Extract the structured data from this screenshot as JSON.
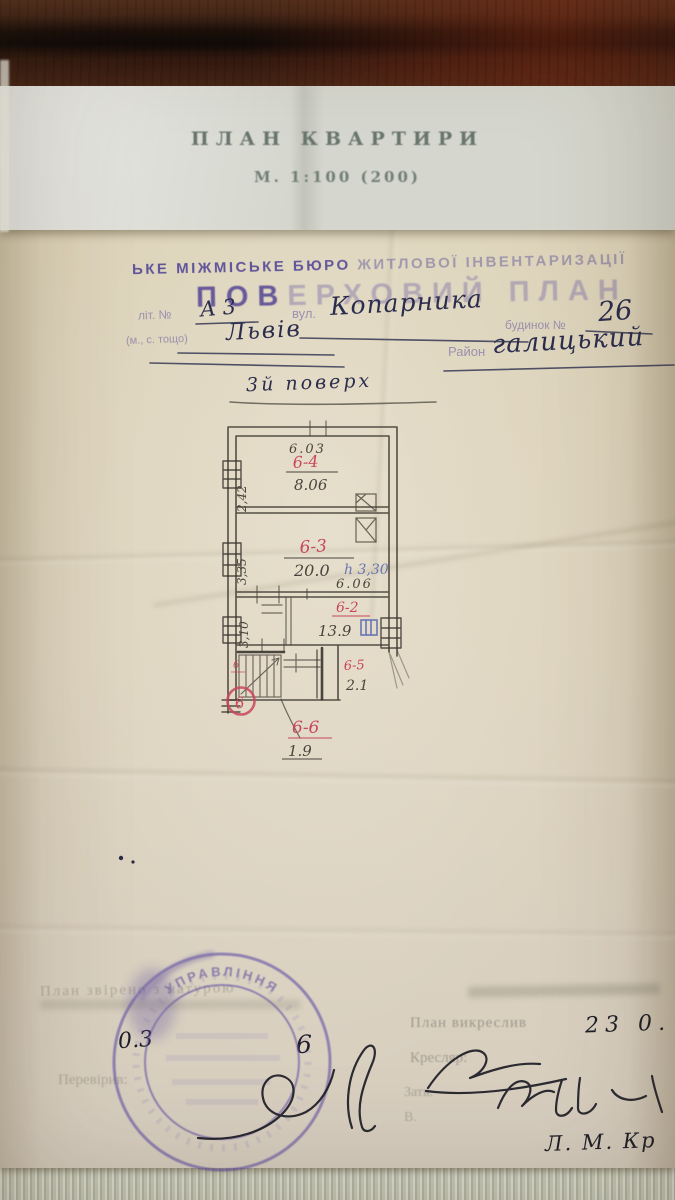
{
  "colors": {
    "red_pencil": "#c9465b",
    "blue_ink": "#4a5fae",
    "stamp_purple": "#584a9c",
    "hand_ink": "#2b2d4e"
  },
  "header_sheet": {
    "title": "ПЛАН КВАРТИРИ",
    "scale": "М. 1:100 (200)"
  },
  "stamp": {
    "line1a": "ЬКЕ МІЖМІСЬКЕ БЮРО",
    "line1b": "ЖИТЛОВОЇ ІНВЕНТАРИЗАЦІЇ",
    "line2a": "ПОВ",
    "line2b": "ЕРХОВИЙ ПЛАН",
    "lit_label": "літ. №",
    "street_label": "вул.",
    "house_label": "будинок №",
    "city_label": "(м., с. тощо)",
    "district_label": "Район"
  },
  "handwritten": {
    "lit": "А 3",
    "street": "Копарника",
    "house": "26",
    "city": "Львів",
    "district": "галицький",
    "floor": "3й поверх",
    "date_day": "0.3",
    "date_year": "6",
    "drawn_date": "23 0.",
    "name": "Л. М. Кр"
  },
  "plan": {
    "dims": {
      "top": "6.03",
      "mid": "6.06",
      "left1": "2,42",
      "left2": "3,35",
      "left3": "3,10"
    },
    "rooms": [
      {
        "id": "6-4",
        "area": "8.06"
      },
      {
        "id": "6-3",
        "area": "20.0",
        "height": "h 3,30"
      },
      {
        "id": "6-2",
        "area": "13.9"
      },
      {
        "id": "6-5",
        "area": "2.1"
      },
      {
        "id": "6-6",
        "area": "1.9"
      }
    ],
    "marks": {
      "apartment": "6",
      "corner": "6"
    }
  },
  "footer": {
    "faded_check": "План звірено з натурою",
    "checked_label": "Перевірив:",
    "drawn_label": "План викреслив",
    "drafter_label": "Кресляр:",
    "approved_label": "Затв.",
    "v_label": "В.",
    "stamp_ring": "УПРАВЛІННЯ"
  }
}
